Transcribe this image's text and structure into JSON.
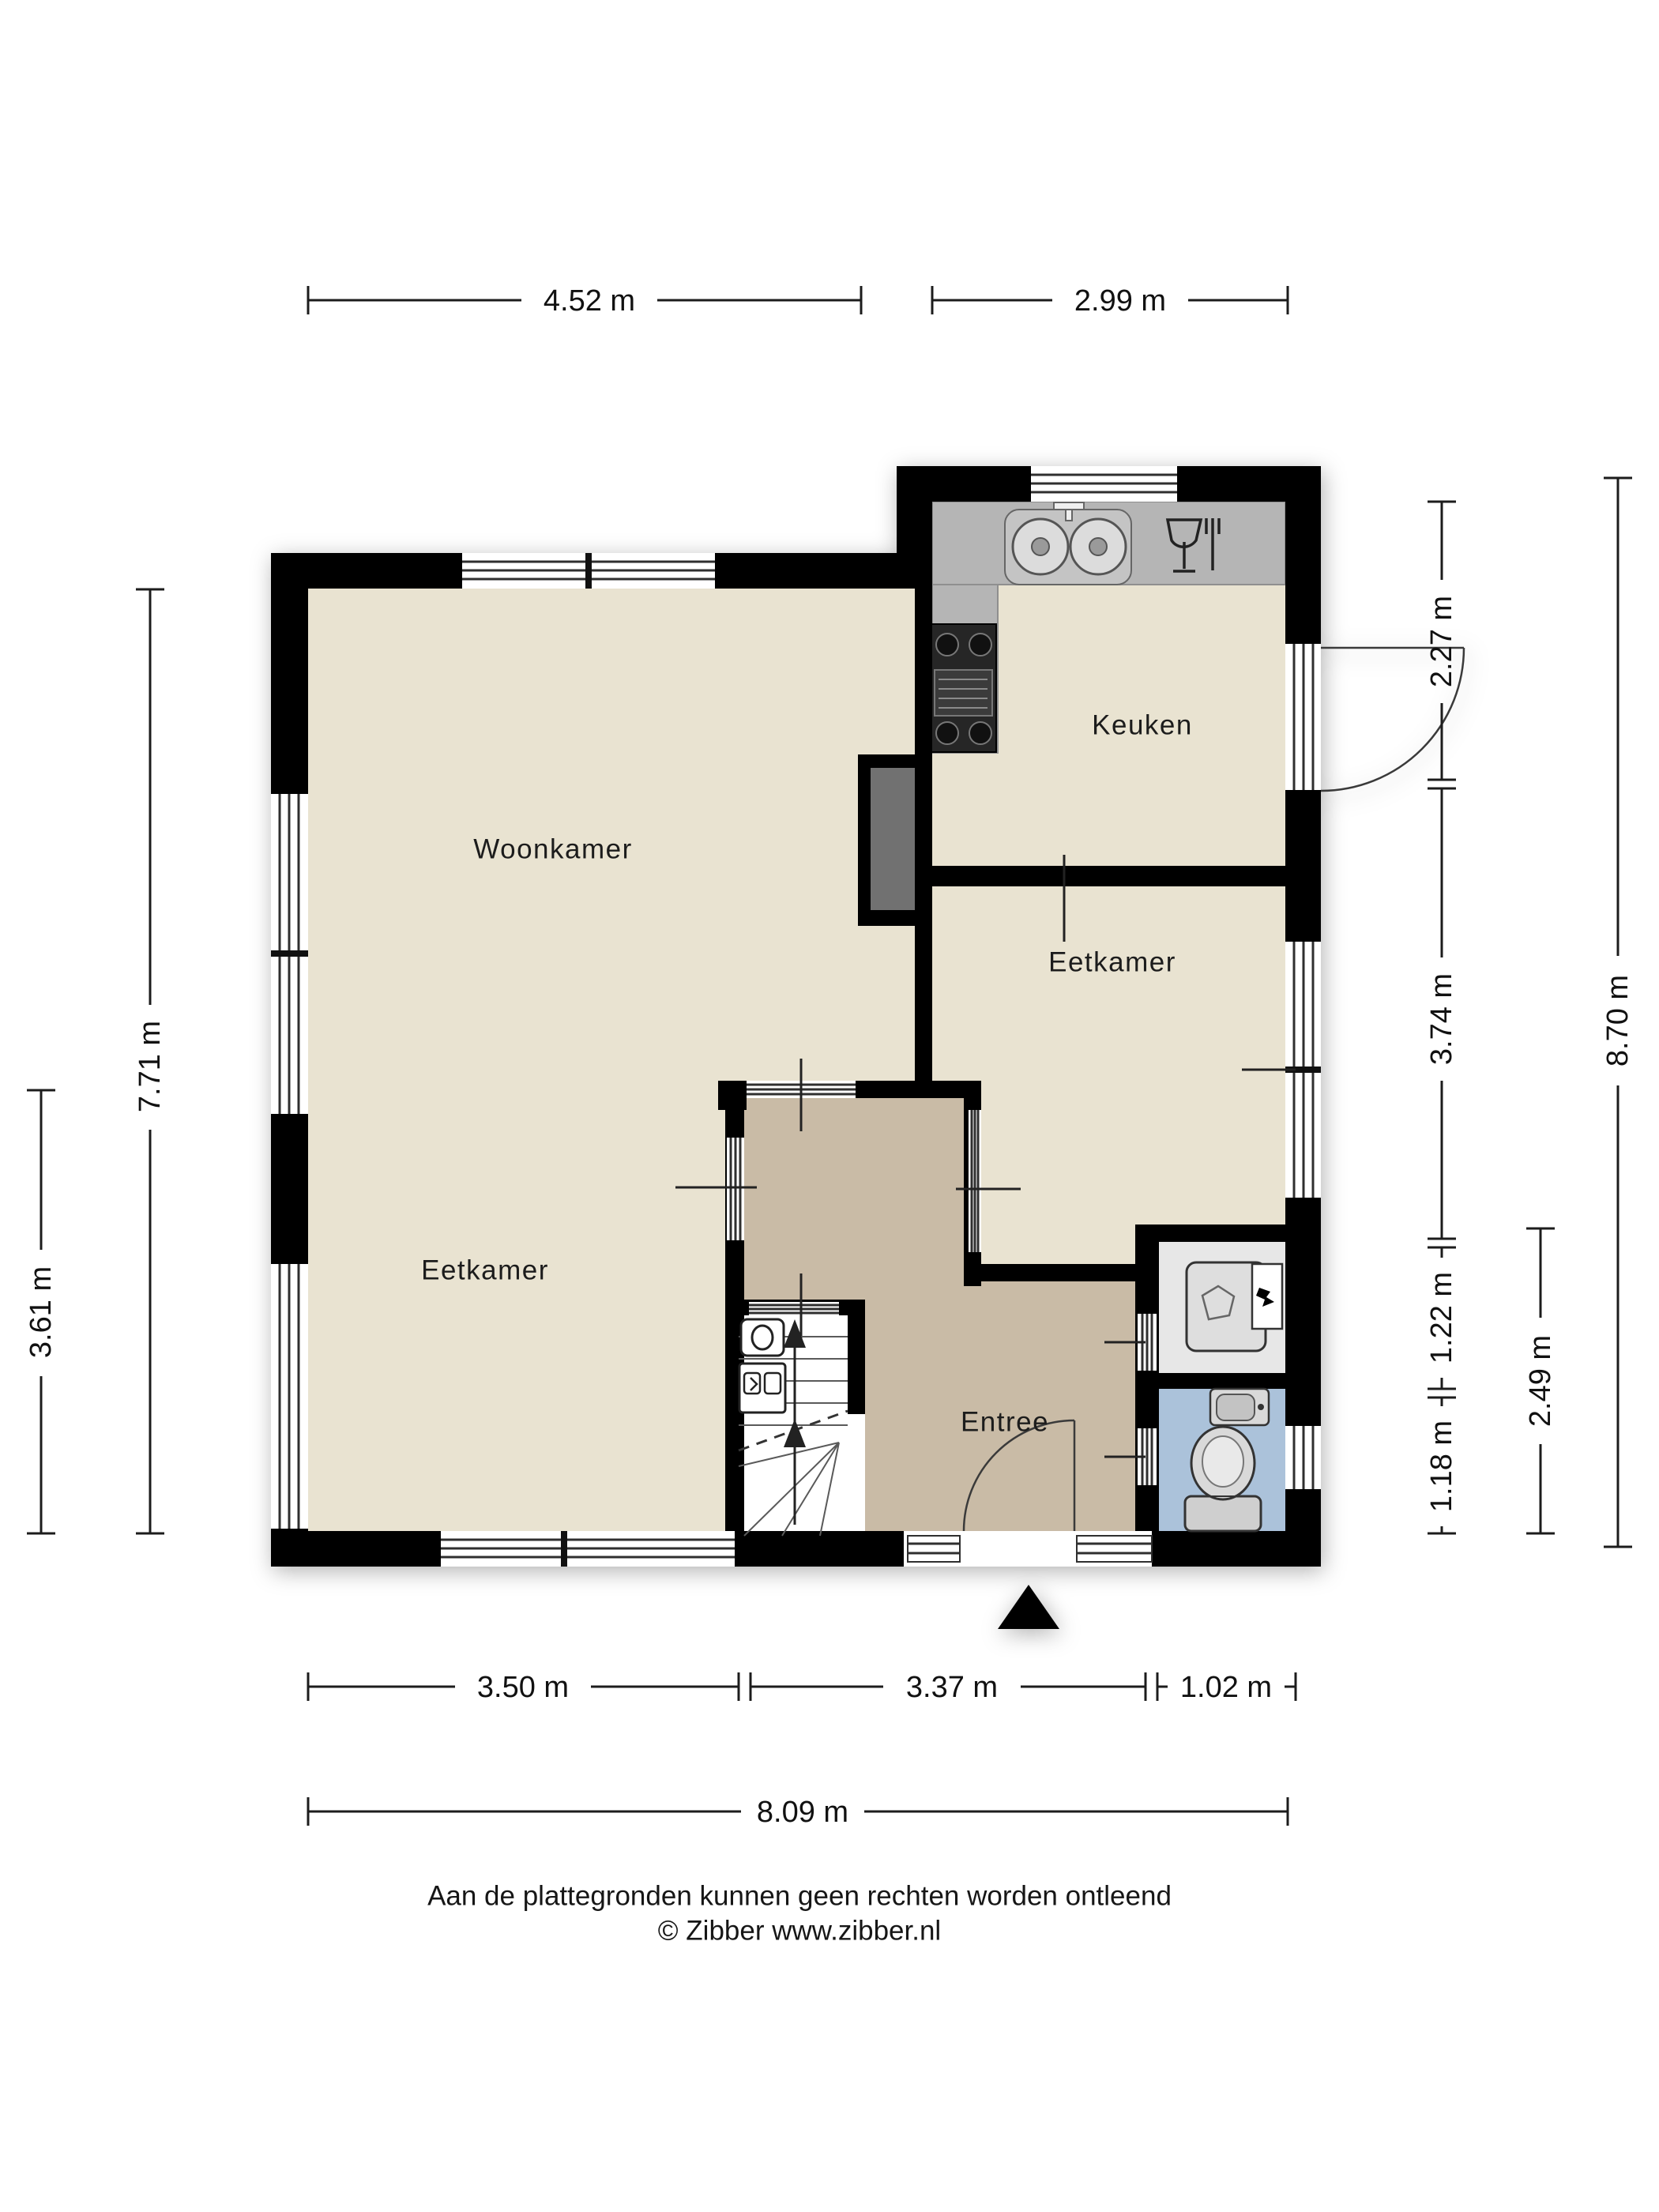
{
  "rooms": {
    "woonkamer": "Woonkamer",
    "keuken": "Keuken",
    "eetkamer_rechts": "Eetkamer",
    "eetkamer_links": "Eetkamer",
    "entree": "Entree"
  },
  "dimensions": {
    "top": [
      "4.52 m",
      "2.99 m"
    ],
    "bottom": [
      "3.50 m",
      "3.37 m",
      "1.02 m"
    ],
    "bottom_total": "8.09 m",
    "left": [
      "7.71 m",
      "3.61 m"
    ],
    "right": [
      "2.27 m",
      "3.74 m",
      "1.22 m",
      "1.18 m"
    ],
    "right_outer": [
      "2.49 m",
      "8.70 m"
    ]
  },
  "footer": {
    "disclaimer": "Aan de plattegronden kunnen geen rechten worden ontleend",
    "copyright": "© Zibber www.zibber.nl"
  },
  "colors": {
    "wall": "#000000",
    "floor": "#e9e3d1",
    "entree": "#c9bba6",
    "counter": "#b5b5b5",
    "counter_edge": "#8f8f8f",
    "chimney": "#717171",
    "utility": "#e7e7e7",
    "toilet": "#abc2da",
    "line": "#1c1c1c"
  },
  "icons": {
    "sink": "double-basin-sink-icon",
    "dishwasher": "wine-glass-fork-icon",
    "stove": "four-burner-stove-icon",
    "washing_machine": "washing-machine-icon",
    "toilet": "toilet-icon",
    "hand_basin": "hand-basin-icon",
    "meter_cabinet": "meter-cabinet-icon",
    "stairs": "staircase-up-arrow-icon",
    "entrance": "entrance-triangle-icon"
  }
}
